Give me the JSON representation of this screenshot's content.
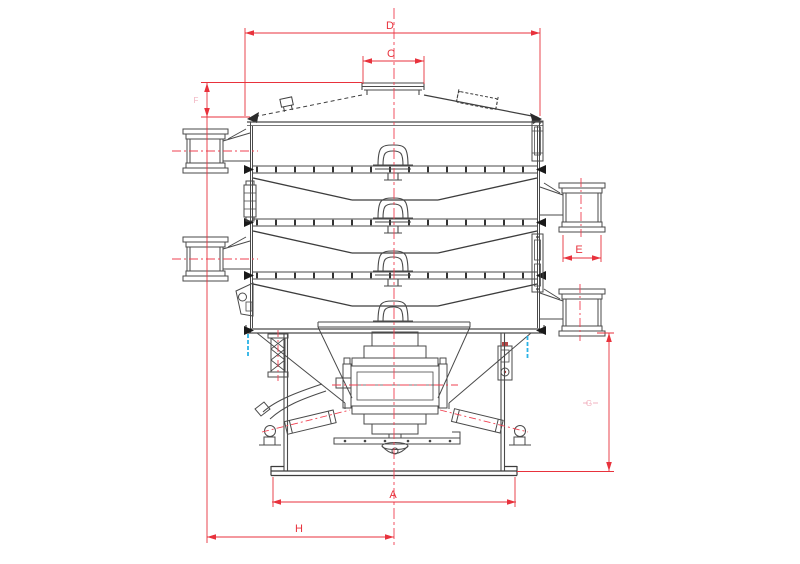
{
  "diagram": {
    "type": "engineering-drawing",
    "subject": "rotary vibrating screen separator - front sectional view with dimensions",
    "labels": {
      "A": "A",
      "C": "C",
      "D": "D",
      "E": "E",
      "F": "F",
      "G": "G",
      "H": "H"
    },
    "label_meanings": {
      "A": "base width",
      "C": "top inlet diameter",
      "D": "top cover diameter",
      "E": "side outlet diameter",
      "F": "lid height",
      "G": "base height",
      "H": "outlet center to machine center distance"
    },
    "colors": {
      "dimension_red": "#e8323c",
      "faint_label_pink": "#f2b3c0",
      "drawing_line": "#454545",
      "accent_cyan": "#2ab3e6",
      "background": "#ffffff"
    }
  }
}
